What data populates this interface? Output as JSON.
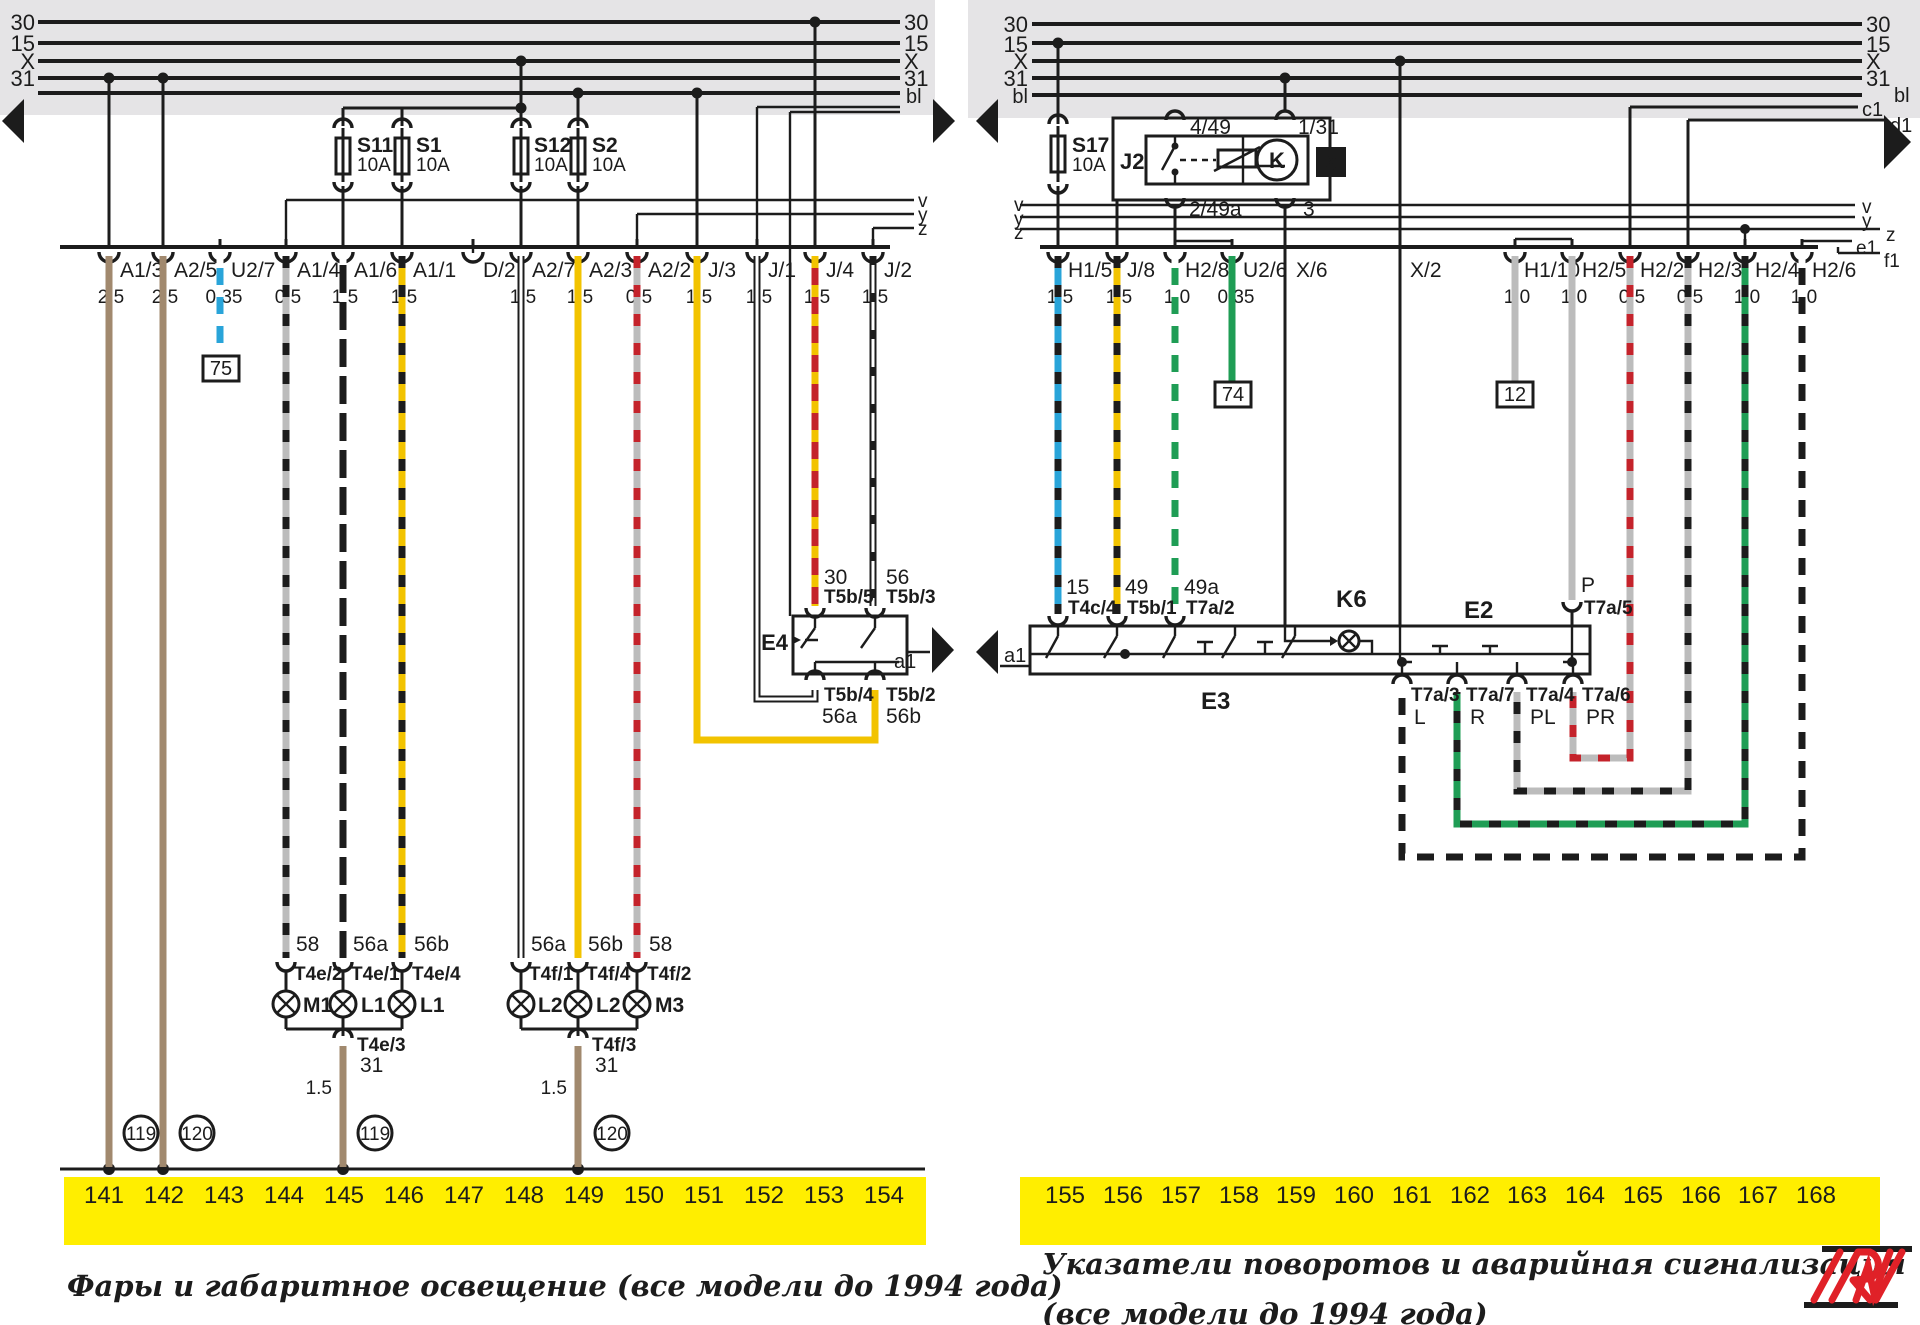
{
  "colors": {
    "band": "#e5e4e6",
    "bar": "#ffee00",
    "brown": "#a1896e",
    "blue": "#29a4d9",
    "yellow": "#f2c300",
    "red": "#c4232b",
    "green": "#1f9d55",
    "grey": "#bcbcbc",
    "black": "#1c1c1c",
    "logo": "#e02128"
  },
  "left": {
    "bus": {
      "b30": "30",
      "b15": "15",
      "bx": "X",
      "b31": "31",
      "bl": "bl"
    },
    "edge": {
      "v": "v",
      "y": "y",
      "z": "z"
    },
    "fuses": [
      {
        "name": "S11",
        "amps": "10A"
      },
      {
        "name": "S1",
        "amps": "10A"
      },
      {
        "name": "S12",
        "amps": "10A"
      },
      {
        "name": "S2",
        "amps": "10A"
      }
    ],
    "connectors": [
      {
        "label": "A1/3",
        "gauge": "2.5"
      },
      {
        "label": "A2/5",
        "gauge": "2.5"
      },
      {
        "label": "U2/7",
        "gauge": "0.35"
      },
      {
        "label": "A1/4",
        "gauge": "0.5"
      },
      {
        "label": "A1/6",
        "gauge": "1.5"
      },
      {
        "label": "A1/1",
        "gauge": "1.5"
      },
      {
        "label": "D/2",
        "gauge": ""
      },
      {
        "label": "A2/7",
        "gauge": "1.5"
      },
      {
        "label": "A2/3",
        "gauge": "1.5"
      },
      {
        "label": "A2/2",
        "gauge": "0.5"
      },
      {
        "label": "J/3",
        "gauge": "1.5"
      },
      {
        "label": "J/1",
        "gauge": "1.5"
      },
      {
        "label": "J/4",
        "gauge": "1.5"
      },
      {
        "label": "J/2",
        "gauge": "1.5"
      }
    ],
    "ref75": "75",
    "e4": {
      "name": "E4",
      "a1": "a1",
      "pin30": "30",
      "t5b5": "T5b/5",
      "pin56": "56",
      "t5b3": "T5b/3",
      "t5b4": "T5b/4",
      "pin56a": "56a",
      "t5b2": "T5b/2",
      "pin56b": "56b"
    },
    "lamps1": {
      "pin1": "58",
      "pin2": "56a",
      "pin3": "56b",
      "t1": "T4e/2",
      "t2": "T4e/1",
      "t3": "T4e/4",
      "b1": "M1",
      "b2": "L1",
      "b3": "L1",
      "gt": "T4e/3",
      "gpin": "31",
      "gauge": "1.5"
    },
    "lamps2": {
      "pin1": "56a",
      "pin2": "56b",
      "pin3": "58",
      "t1": "T4f/1",
      "t2": "T4f/4",
      "t3": "T4f/2",
      "b1": "L2",
      "b2": "L2",
      "b3": "M3",
      "gt": "T4f/3",
      "gpin": "31",
      "gauge": "1.5"
    },
    "grounds": [
      "119",
      "120",
      "119",
      "120"
    ],
    "track": [
      "141",
      "142",
      "143",
      "144",
      "145",
      "146",
      "147",
      "148",
      "149",
      "150",
      "151",
      "152",
      "153",
      "154"
    ],
    "caption": "Фары и габаритное освещение (все модели до 1994 года)"
  },
  "right": {
    "bus": {
      "b30": "30",
      "b15": "15",
      "bx": "X",
      "b31": "31",
      "bl": "bl",
      "c1": "c1",
      "d1": "d1"
    },
    "edge": {
      "v": "v",
      "y": "y",
      "z": "z",
      "e1": "e1",
      "f1": "f1"
    },
    "fuse": {
      "name": "S17",
      "amps": "10A"
    },
    "relay": {
      "name": "J2",
      "k": "K",
      "badge": "6",
      "t1": "4/49",
      "t2": "1/31",
      "t3": "2/49a",
      "t4": "3"
    },
    "connectors": [
      {
        "label": "H1/5",
        "gauge": "1.5"
      },
      {
        "label": "J/8",
        "gauge": "1.5"
      },
      {
        "label": "H2/8",
        "gauge": "1.0"
      },
      {
        "label": "U2/6",
        "gauge": "0.35"
      },
      {
        "label": "X/6",
        "gauge": ""
      },
      {
        "label": "X/2",
        "gauge": ""
      },
      {
        "label": "H1/10",
        "gauge": "1.0"
      },
      {
        "label": "H2/5",
        "gauge": "1.0"
      },
      {
        "label": "H2/2",
        "gauge": "0.5"
      },
      {
        "label": "H2/3",
        "gauge": "0.5"
      },
      {
        "label": "H2/4",
        "gauge": "1.0"
      },
      {
        "label": "H2/6",
        "gauge": "1.0"
      }
    ],
    "ref74": "74",
    "ref12": "12",
    "sw": {
      "k6": "K6",
      "e2": "E2",
      "e3": "E3",
      "a1": "a1",
      "pin15": "15",
      "t4c4": "T4c/4",
      "pin49": "49",
      "t5b1": "T5b/1",
      "pin49a": "49a",
      "t7a2": "T7a/2",
      "pinP": "P",
      "t7a5": "T7a/5",
      "t7a3": "T7a/3",
      "pinL": "L",
      "t7a7": "T7a/7",
      "pinR": "R",
      "t7a4": "T7a/4",
      "pinPL": "PL",
      "t7a6": "T7a/6",
      "pinPR": "PR"
    },
    "track": [
      "155",
      "156",
      "157",
      "158",
      "159",
      "160",
      "161",
      "162",
      "163",
      "164",
      "165",
      "166",
      "167",
      "168"
    ],
    "caption1": "Указатели поворотов и аварийная сигнализация",
    "caption2": "(все модели до 1994 года)"
  }
}
